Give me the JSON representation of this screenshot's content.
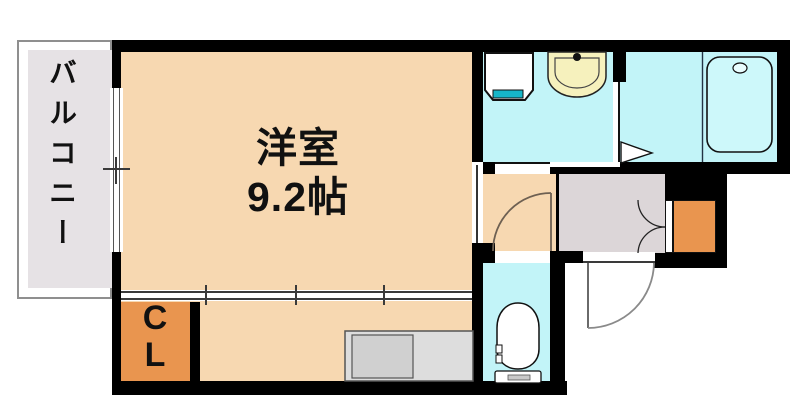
{
  "labels": {
    "balcony": "バルコニー",
    "room_name": "洋室",
    "room_size": "9.2帖",
    "closet": [
      "C",
      "L"
    ]
  },
  "fixtures": {
    "washing_machine": "washing-machine-pan",
    "washbasin": "washbasin-with-faucet",
    "bathtub": "bathtub",
    "toilet": "toilet",
    "kitchen_counter": "kitchen-counter-with-sink",
    "doors": [
      "hinged-door-toilet",
      "entrance-door",
      "double-door-storage",
      "bathroom-door",
      "sliding-window"
    ]
  },
  "colors": {
    "wall": "#000000",
    "room_floor": "#F7D8B1",
    "wet_area_floor": "#C2F4F8",
    "balcony_floor": "#E6E2E5",
    "entry_floor": "#DCD6D8",
    "closet_fill": "#E9954F",
    "storage_fill": "#E9954F",
    "basin_fill": "#F6F1BD",
    "washer_accent": "#16B6C8",
    "counter_fill": "#DDDDDD",
    "tub_fill": "#CDF8FA"
  }
}
